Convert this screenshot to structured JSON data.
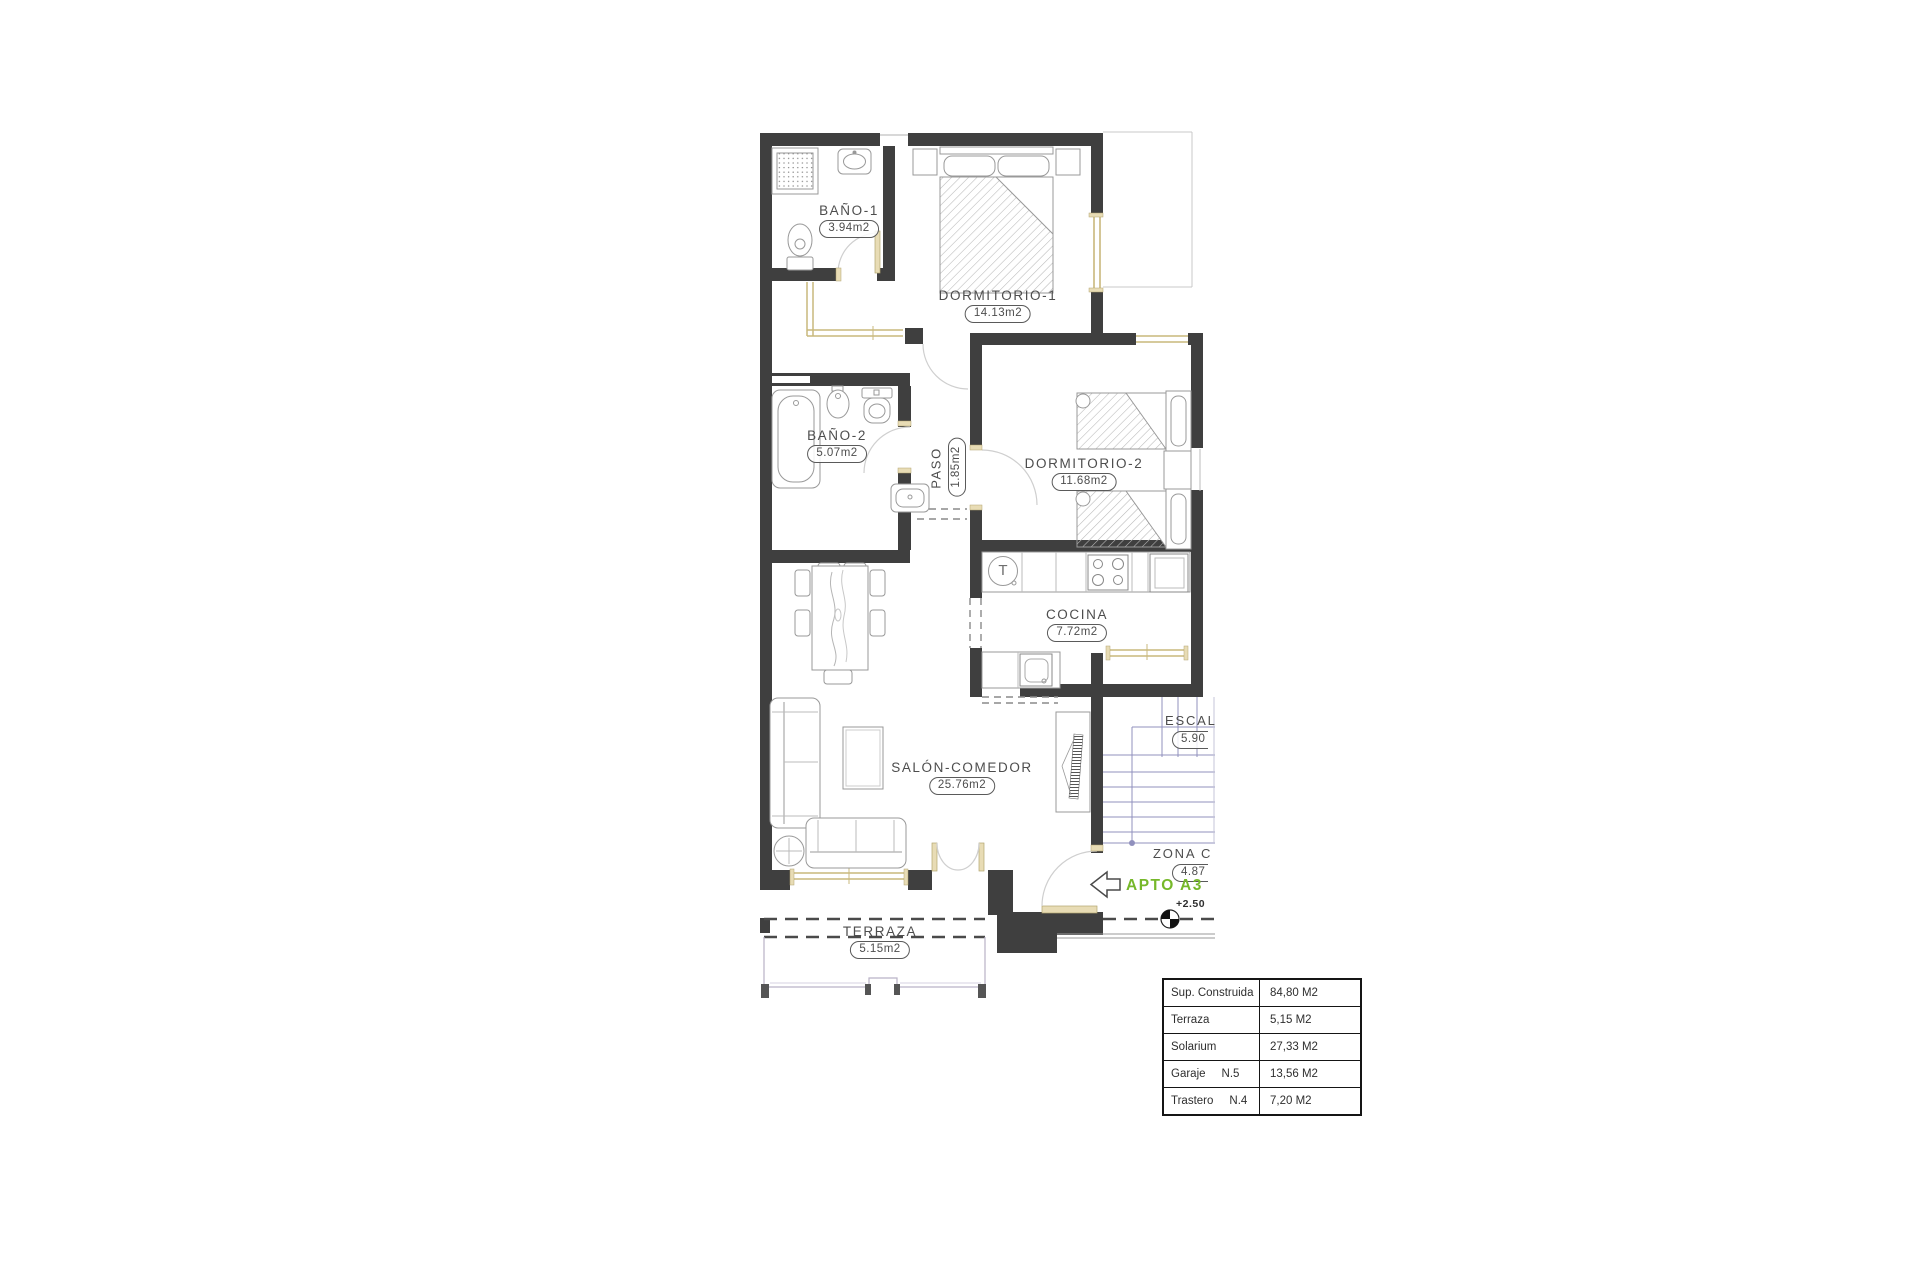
{
  "plan": {
    "rooms": [
      {
        "name": "BAÑO-1",
        "area": "3.94m2"
      },
      {
        "name": "DORMITORIO-1",
        "area": "14.13m2"
      },
      {
        "name": "BAÑO-2",
        "area": "5.07m2"
      },
      {
        "name": "PASO",
        "area": "1.85m2"
      },
      {
        "name": "DORMITORIO-2",
        "area": "11.68m2"
      },
      {
        "name": "COCINA",
        "area": "7.72m2"
      },
      {
        "name": "SALÓN-COMEDOR",
        "area": "25.76m2"
      },
      {
        "name": "TERRAZA",
        "area": "5.15m2"
      }
    ],
    "common_zones": [
      {
        "name": "ESCAL",
        "area": "5.90"
      },
      {
        "name": "ZONA C",
        "area": "4.87"
      }
    ],
    "apartment_tag": "APTO A3",
    "level_mark": "+2.50",
    "washer_symbol": "T",
    "colors": {
      "wall": "#3f3f3f",
      "accent_green": "#76b82a",
      "casing": "#e8dcb5",
      "stairs": "#9090bd"
    }
  },
  "summary_table": {
    "rows": [
      {
        "label": "Sup. Construida",
        "code": "",
        "value": "84,80 M2"
      },
      {
        "label": "Terraza",
        "code": "",
        "value": "5,15 M2"
      },
      {
        "label": "Solarium",
        "code": "",
        "value": "27,33 M2"
      },
      {
        "label": "Garaje",
        "code": "N.5",
        "value": "13,56 M2"
      },
      {
        "label": "Trastero",
        "code": "N.4",
        "value": "7,20 M2"
      }
    ]
  }
}
